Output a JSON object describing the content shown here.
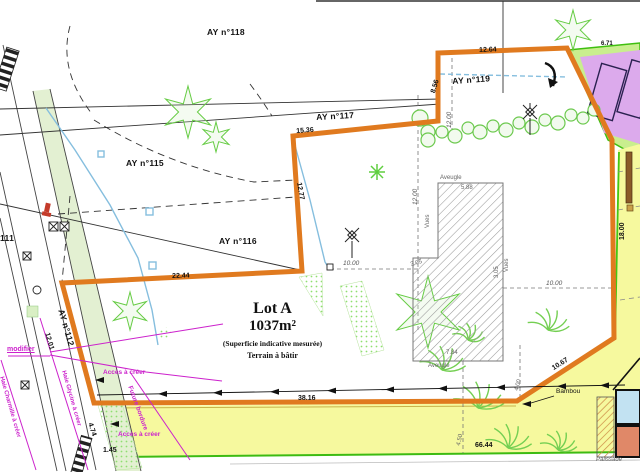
{
  "parcel_labels": {
    "ay118": "AY n°118",
    "ay117": "AY n°117",
    "ay119": "AY n°119",
    "ay115": "AY n°115",
    "ay116": "AY n°116",
    "ay112": "AY n°112",
    "p111": "111"
  },
  "lot": {
    "name": "Lot A",
    "area": "1037m²",
    "note1": "(Superficie indicative mesurée)",
    "note2": "Terrain à bâtir"
  },
  "dims": {
    "d1264": "12.64",
    "d856": "8.56",
    "d1536": "15.36",
    "d1277": "12.77",
    "d2244": "22.44",
    "d1201": "12.01",
    "d474": "4.74",
    "d145": "1.45",
    "d3816": "38.16",
    "d6644": "66.44",
    "d1067": "10.67",
    "d1800": "18.00",
    "d1200a": "12.00",
    "d1200b": "12.00",
    "d1000a": "10.00",
    "d1000b": "10.00",
    "d588": "5.88",
    "d784": "7.84",
    "d305a": "3.05",
    "d305b": "3.05",
    "d400": "4.00",
    "d450": "4.50",
    "d671": "6.71"
  },
  "building_labels": {
    "aveugle_top": "Aveugle",
    "aveugle_bottom": "Aveugle",
    "vues_left": "Vues",
    "vues_right": "Vues"
  },
  "annotations": {
    "modifier": "modifier",
    "acces1": "Accès à créer",
    "acces2": "Accès à créer",
    "future_bordure": "Future bordure",
    "haie1": "Haie Charmille à créer",
    "haie2": "Haie Glycine à créer",
    "bambou": "Bambou",
    "palissade": "Palissade"
  },
  "colors": {
    "boundary": "#E07A1F",
    "vegetation": "#5FCE3F",
    "annotation": "#CC22CC",
    "zone_purple": "#DCAAEC",
    "zone_yellow": "#F6F99E",
    "zone_green": "#C9EE8E",
    "utility_line": "#85BEDE"
  }
}
